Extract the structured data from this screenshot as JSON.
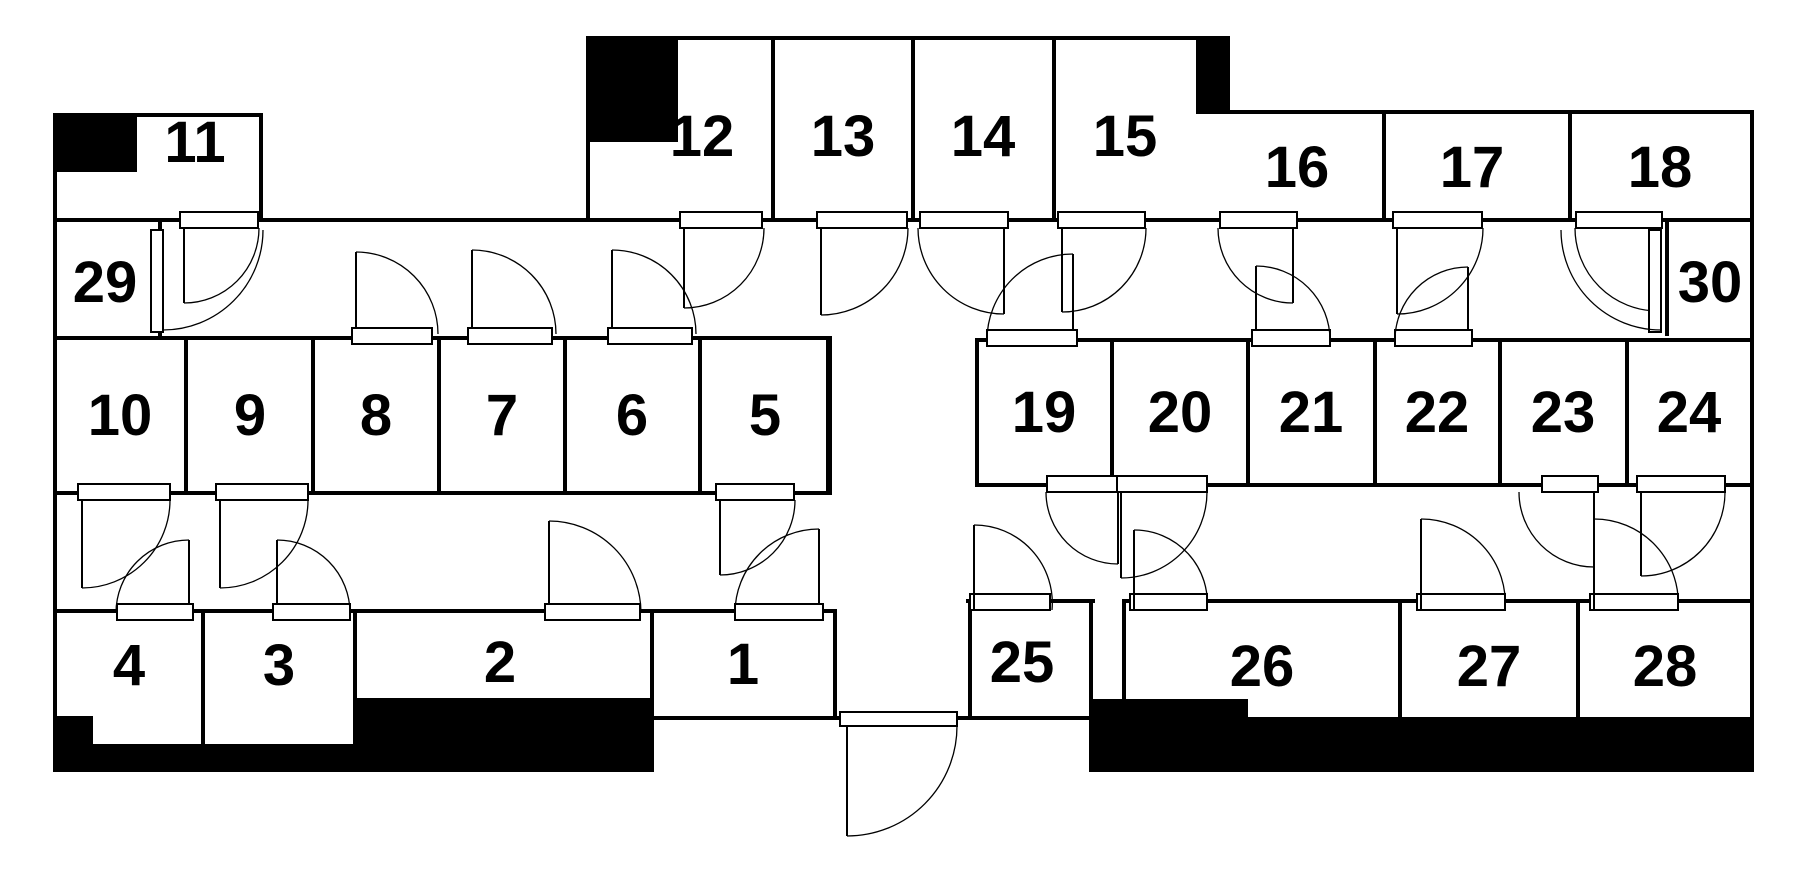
{
  "plan": {
    "colors": {
      "wall": "#000000",
      "background": "#ffffff"
    },
    "rooms": [
      {
        "label": "1"
      },
      {
        "label": "2"
      },
      {
        "label": "3"
      },
      {
        "label": "4"
      },
      {
        "label": "5"
      },
      {
        "label": "6"
      },
      {
        "label": "7"
      },
      {
        "label": "8"
      },
      {
        "label": "9"
      },
      {
        "label": "10"
      },
      {
        "label": "11"
      },
      {
        "label": "12"
      },
      {
        "label": "13"
      },
      {
        "label": "14"
      },
      {
        "label": "15"
      },
      {
        "label": "16"
      },
      {
        "label": "17"
      },
      {
        "label": "18"
      },
      {
        "label": "19"
      },
      {
        "label": "20"
      },
      {
        "label": "21"
      },
      {
        "label": "22"
      },
      {
        "label": "23"
      },
      {
        "label": "24"
      },
      {
        "label": "25"
      },
      {
        "label": "26"
      },
      {
        "label": "27"
      },
      {
        "label": "28"
      },
      {
        "label": "29"
      },
      {
        "label": "30"
      }
    ]
  }
}
